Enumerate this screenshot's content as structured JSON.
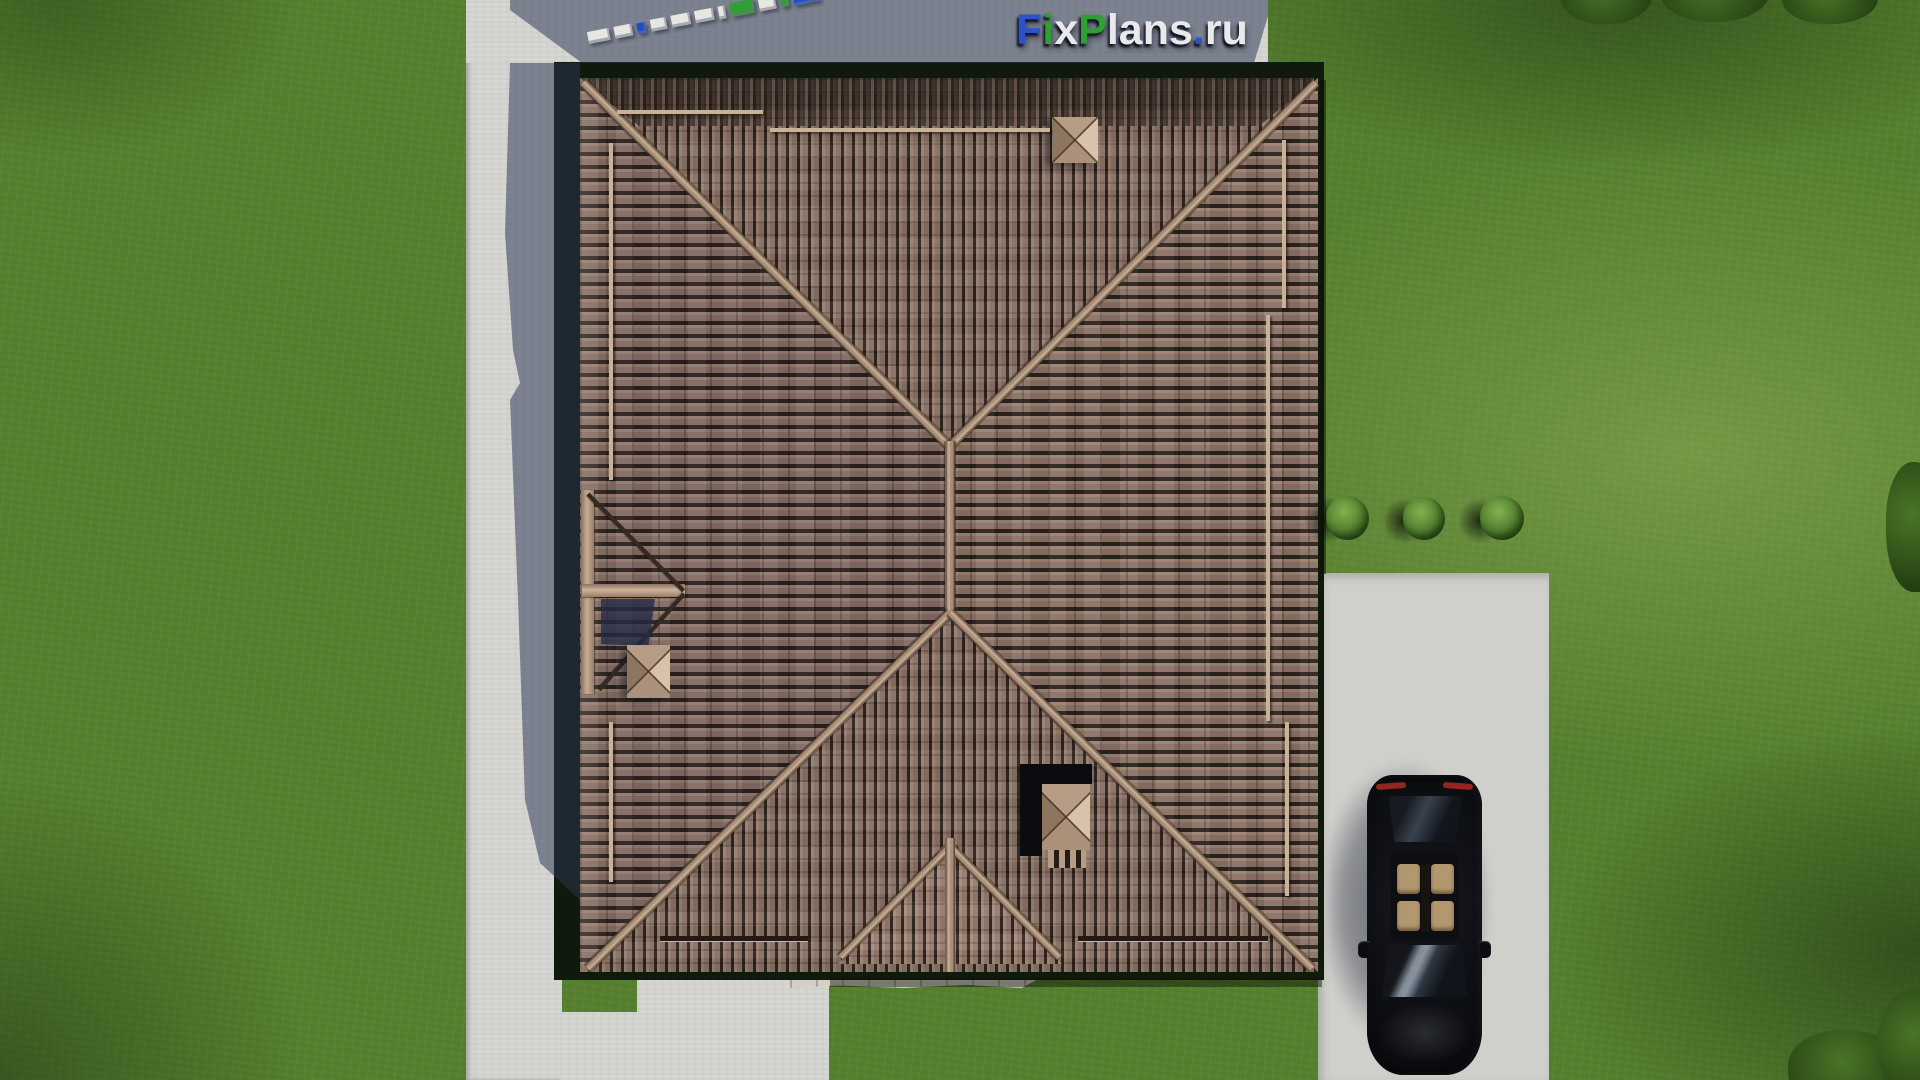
{
  "watermark": {
    "text": "FixPlans.ru",
    "letters": [
      {
        "ch": "F",
        "color": "#2b52c6"
      },
      {
        "ch": "i",
        "color": "#2f9e33"
      },
      {
        "ch": "x",
        "color": "#e9e9ec"
      },
      {
        "ch": "P",
        "color": "#2f9e33"
      },
      {
        "ch": "l",
        "color": "#e9e9ec"
      },
      {
        "ch": "a",
        "color": "#e9e9ec"
      },
      {
        "ch": "n",
        "color": "#e9e9ec"
      },
      {
        "ch": "s",
        "color": "#e9e9ec"
      },
      {
        "ch": ".",
        "color": "#2b52c6"
      },
      {
        "ch": "r",
        "color": "#e9e9ec"
      },
      {
        "ch": "u",
        "color": "#e9e9ec"
      }
    ]
  },
  "ground_text_3d": {
    "text": "FixPlans.ru",
    "blocks": [
      {
        "ch": "u",
        "w": 22,
        "h": 12,
        "color": "#e6e6e3"
      },
      {
        "ch": "r",
        "w": 18,
        "h": 12,
        "color": "#e6e6e3"
      },
      {
        "ch": ".",
        "w": 9,
        "h": 11,
        "color": "#1d50c8"
      },
      {
        "ch": "s",
        "w": 16,
        "h": 12,
        "color": "#e6e6e3"
      },
      {
        "ch": "n",
        "w": 19,
        "h": 12,
        "color": "#e6e6e3"
      },
      {
        "ch": "a",
        "w": 19,
        "h": 12,
        "color": "#e6e6e3"
      },
      {
        "ch": "l",
        "w": 7,
        "h": 13,
        "color": "#e6e6e3"
      },
      {
        "ch": "P",
        "w": 24,
        "h": 14,
        "color": "#2f9e33"
      },
      {
        "ch": "x",
        "w": 17,
        "h": 13,
        "color": "#e6e6e3"
      },
      {
        "ch": "i",
        "w": 8,
        "h": 13,
        "color": "#2f9e33"
      },
      {
        "ch": "F",
        "w": 26,
        "h": 16,
        "color": "#1d50c8"
      }
    ]
  },
  "palette": {
    "grass": "#56802f",
    "grass_light": "#7da04b",
    "grass_dark": "#3c5a23",
    "concrete": "#d6d6d2",
    "concrete_shadow": "#5f667b",
    "roof_tile": "#8d7568",
    "roof_gap": "#2b221c",
    "ridge": "#c9b299",
    "eave": "#101a0c",
    "driveway": "#cfcfcb",
    "car": "#0b0b0e",
    "seat": "#b2976f",
    "taillight": "#93251f",
    "bush": "#55832f"
  }
}
